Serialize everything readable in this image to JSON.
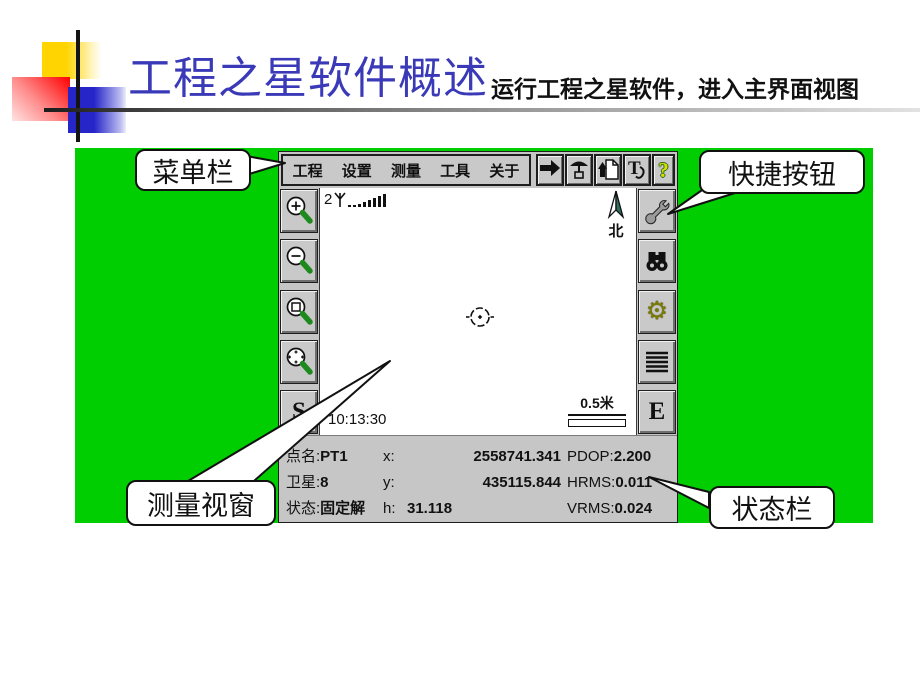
{
  "slide": {
    "title": "工程之星软件概述",
    "subtitle": "运行工程之星软件，进入主界面视图"
  },
  "callouts": {
    "menu_bar": "菜单栏",
    "quick_buttons": "快捷按钮",
    "measure_window": "测量视窗",
    "status_bar": "状态栏"
  },
  "device": {
    "menu": {
      "items": [
        "工程",
        "设置",
        "测量",
        "工具",
        "关于"
      ]
    },
    "quick_toolbar": {
      "icons": [
        "arrow-right",
        "base-station",
        "file-upload",
        "text-annotate",
        "help"
      ],
      "help_glyph": "?"
    },
    "left_toolbar": {
      "icons": [
        "zoom-in",
        "zoom-out",
        "zoom-window",
        "pan-center"
      ],
      "s_label": "S"
    },
    "right_toolbar": {
      "icons": [
        "wrench",
        "binoculars",
        "gear",
        "list-lines"
      ],
      "gear_glyph": "⚙",
      "e_label": "E"
    },
    "canvas": {
      "signal_count": "2",
      "north_label": "北",
      "time": "10:13:30",
      "scale_label": "0.5米"
    },
    "status": {
      "point_label": "点名:",
      "point_value": "PT1",
      "sat_label": "卫星:",
      "sat_value": "8",
      "state_label": "状态:",
      "state_value": "固定解",
      "x_label": "x:",
      "x_value": "2558741.341",
      "y_label": "y:",
      "y_value": "435115.844",
      "h_label": "h:",
      "h_value": "31.118",
      "pdop_label": "PDOP:",
      "pdop_value": "2.200",
      "hrms_label": "HRMS:",
      "hrms_value": "0.011",
      "vrms_label": "VRMS:",
      "vrms_value": "0.024"
    }
  },
  "colors": {
    "green_bg": "#00CE00",
    "title_blue": "#3A3AB8",
    "compass_teal": "#2F6F5F",
    "magnifier_handle_green": "#1E8A1E",
    "gear_olive": "#7B7B00",
    "help_yellow": "#DEDE00"
  }
}
